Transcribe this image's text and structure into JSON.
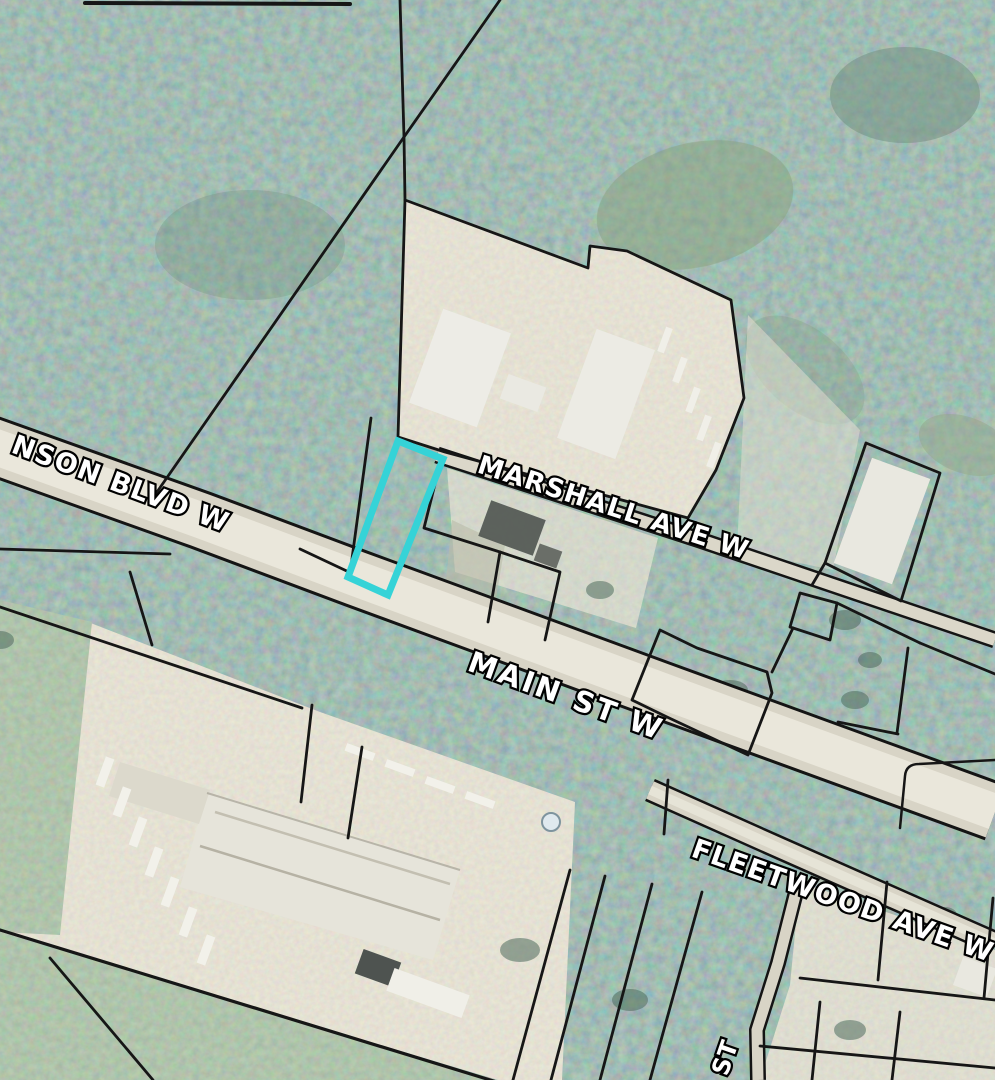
{
  "map": {
    "type": "aerial-parcel-map",
    "highlight_color": "#35d3d7",
    "parcel_line_color": "#161616",
    "road_fill": "#d8d4c6",
    "labels": {
      "blvd": "NSON BLVD W",
      "marshall": "MARSHALL AVE W",
      "main": "MAIN ST W",
      "fleetwood": "FLEETWOOD AVE W",
      "st": "ST"
    }
  }
}
